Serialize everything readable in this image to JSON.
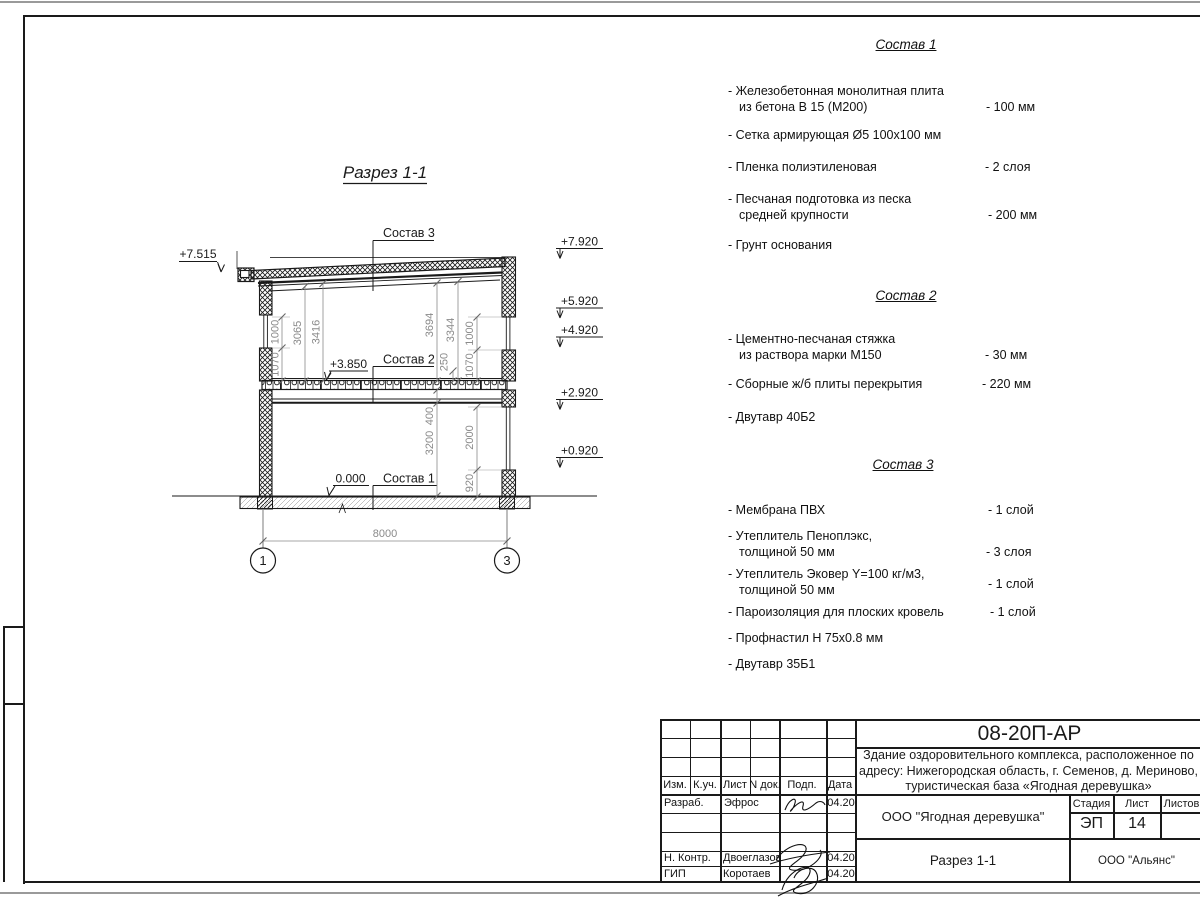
{
  "drawing": {
    "title": "Разрез 1-1",
    "leader_labels": {
      "s3": "Состав 3",
      "s2": "Состав 2",
      "s1": "Состав 1"
    },
    "elev": {
      "p7515": "+7.515",
      "p7920": "+7.920",
      "p5920": "+5.920",
      "p4920": "+4.920",
      "p2920": "+2.920",
      "p0920": "+0.920",
      "p3850": "+3.850",
      "zero": "0.000"
    },
    "dims": {
      "l1000": "1000",
      "l1070": "1070",
      "d3065": "3065",
      "d3416": "3416",
      "d3694": "3694",
      "d3344": "3344",
      "d250": "250",
      "r1000": "1000",
      "r1070": "1070",
      "d400": "400",
      "d3200": "3200",
      "d2000": "2000",
      "d920": "920",
      "d8000": "8000"
    },
    "axis": {
      "a1": "1",
      "a3": "3"
    },
    "colors": {
      "line": "#1a1a1a",
      "dim": "#8a8a8a"
    }
  },
  "compositions": [
    {
      "title": "Состав 1",
      "items": [
        {
          "l1": "- Железобетонная  монолитная плита",
          "l2": "из бетона В 15 (М200)",
          "value": "- 100 мм"
        },
        {
          "l1": "- Сетка армирующая Ø5 100х100 мм"
        },
        {
          "l1": "- Пленка полиэтиленовая",
          "value": "-  2 слоя"
        },
        {
          "l1": "- Песчаная подготовка из песка",
          "l2": "средней крупности",
          "value": "- 200 мм"
        },
        {
          "l1": "- Грунт основания"
        }
      ]
    },
    {
      "title": "Состав 2",
      "items": [
        {
          "l1": "- Цементно-песчаная стяжка",
          "l2": "из раствора марки М150",
          "value": "- 30 мм"
        },
        {
          "l1": "- Сборные ж/б плиты перекрытия",
          "value": "- 220 мм"
        },
        {
          "l1": "- Двутавр 40Б2"
        }
      ]
    },
    {
      "title": "Состав 3",
      "items": [
        {
          "l1": "- Мембрана ПВХ",
          "value": "- 1 слой"
        },
        {
          "l1": "- Утеплитель Пеноплэкс,",
          "l2": "толщиной 50 мм",
          "value": "- 3 слоя"
        },
        {
          "l1": "- Утеплитель Эковер Y=100 кг/м3,",
          "l2": "толщиной 50 мм",
          "value": "- 1 слой"
        },
        {
          "l1": "- Пароизоляция для плоских кровель",
          "value": "- 1 слой"
        },
        {
          "l1": "- Профнастил Н 75х0.8 мм"
        },
        {
          "l1": "- Двутавр 35Б1"
        }
      ]
    }
  ],
  "title_block": {
    "code": "08-20П-АР",
    "project_lines": [
      "Здание оздоровительного комплекса, расположенное по",
      "адресу: Нижегородская область, г. Семенов, д. Мериново,",
      "туристическая база «Ягодная деревушка»"
    ],
    "header_cols": [
      "Изм.",
      "К.уч.",
      "Лист",
      "N док.",
      "Подп.",
      "Дата"
    ],
    "rows": [
      {
        "role": "Разраб.",
        "name": "Эфрос",
        "date": "04.20"
      },
      {
        "role": "Н. Контр.",
        "name": "Двоеглазов",
        "date": "04.20"
      },
      {
        "role": "ГИП",
        "name": "Коротаев",
        "date": "04.20"
      }
    ],
    "client": "ООО \"Ягодная деревушка\"",
    "stage_label": "Стадия",
    "sheet_label": "Лист",
    "sheets_label": "Листов",
    "stage": "ЭП",
    "sheet_num": "14",
    "drawing_name": "Разрез 1-1",
    "org": "ООО \"Альянс\""
  }
}
